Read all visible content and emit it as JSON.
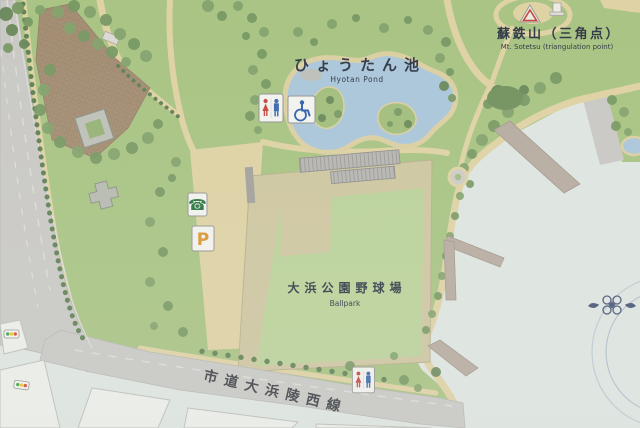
{
  "region_labels": {
    "pond_ja": "ひょうたん池",
    "pond_en": "Hyotan Pond",
    "mountain_ja": "蘇鉄山（三角点）",
    "mountain_en": "Mt. Sotetsu (triangulation point)",
    "ballpark_ja": "大浜公園野球場",
    "ballpark_en": "Ballpark",
    "road_ja": "市道大浜陵西線"
  },
  "map_symbols": {
    "parking_letter": "P",
    "phone_glyph": "☎",
    "toilet_icon": "male-female-restroom-pictogram",
    "wheelchair_icon": "accessible-restroom-pictogram",
    "triangulation_icon": "triangulation-point-marker",
    "traffic_light_icon": "traffic-signal-marker"
  },
  "colors": {
    "lawn": "#a3c07b",
    "open_area": "#dde4df",
    "pond": "#a5c3d8",
    "path": "#ddcf9e",
    "road": "#c6c5c1",
    "plaza_brick": "#a0896d",
    "ballfield_dirt": "#ccc39b",
    "outfield_grass": "#b7d093",
    "tree": "#7b9c63",
    "label_text": "#242b3a",
    "parking_orange": "#d98e1f",
    "phone_green": "#1d6b33",
    "toilet_red": "#c23b30",
    "toilet_blue": "#2f5fa8",
    "emblem_blue": "#3c4a6e"
  }
}
